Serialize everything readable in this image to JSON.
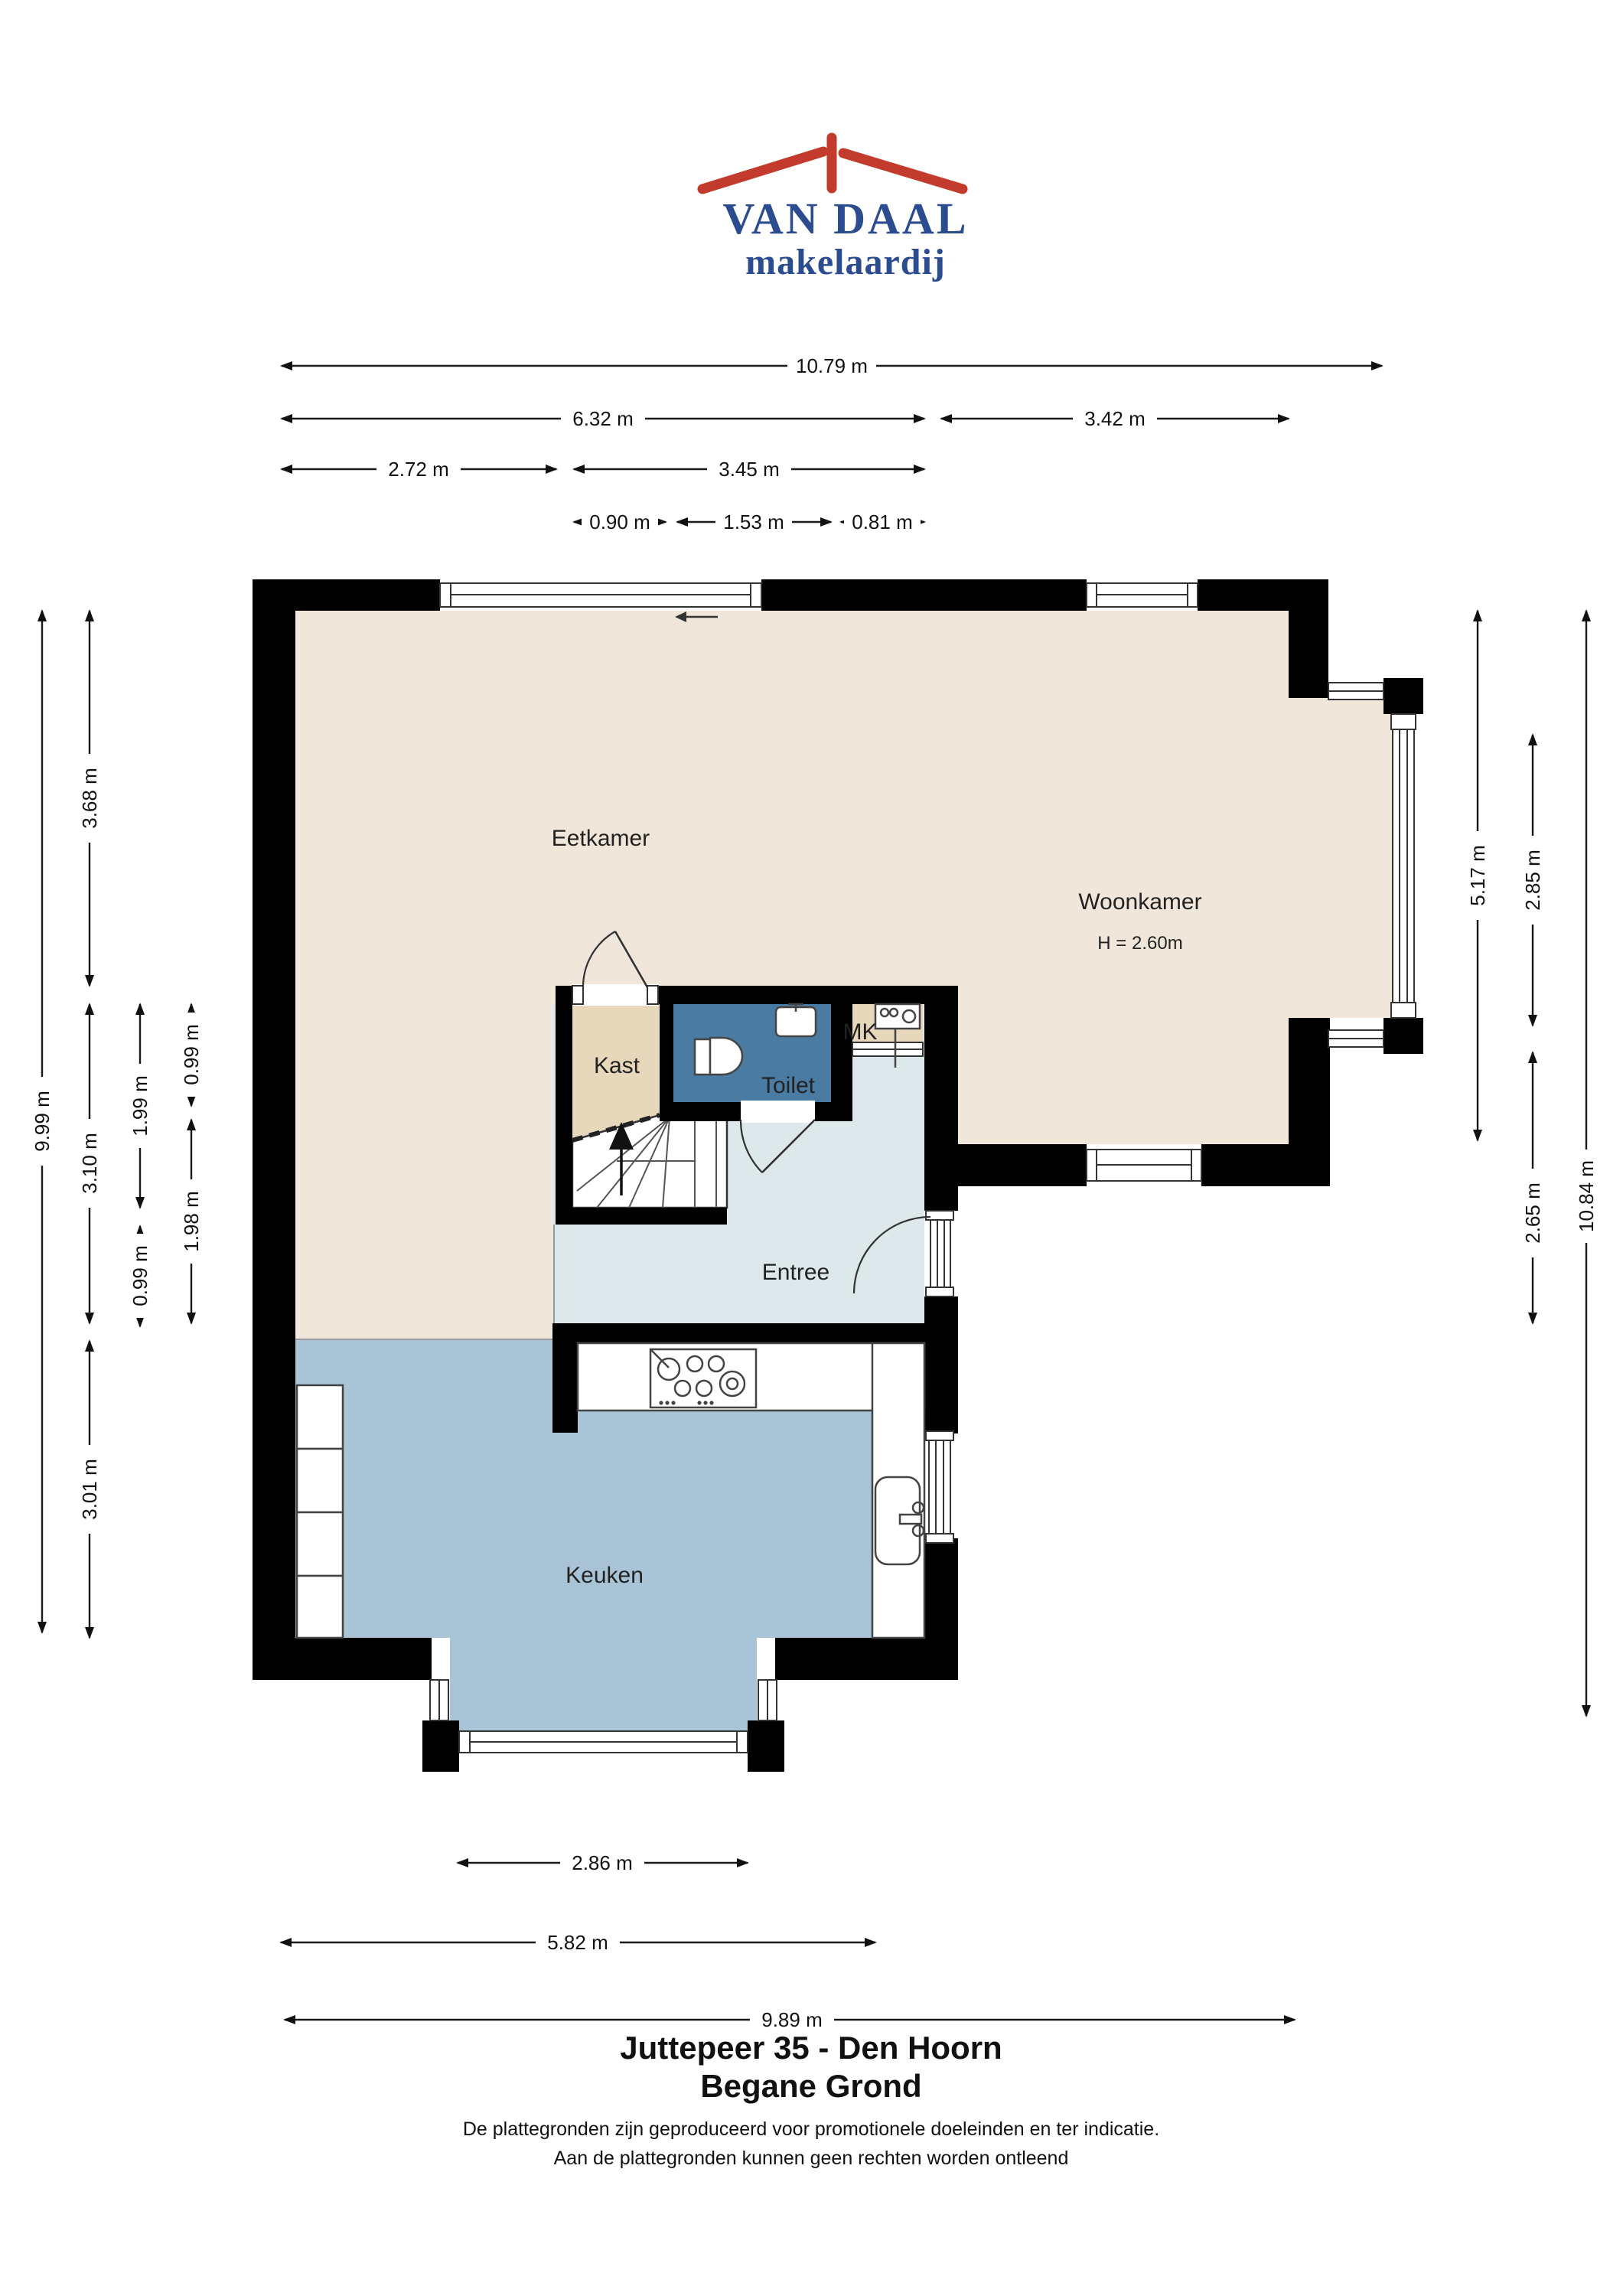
{
  "logo": {
    "brand": "VAN DAAL",
    "tagline": "makelaardij"
  },
  "rooms": {
    "eetkamer": "Eetkamer",
    "woonkamer": "Woonkamer",
    "woonkamer_height": "H = 2.60m",
    "kast": "Kast",
    "toilet": "Toilet",
    "mk": "MK",
    "entree": "Entree",
    "keuken": "Keuken"
  },
  "dimensions": {
    "top": {
      "d1079": "10.79 m",
      "d632": "6.32 m",
      "d342": "3.42 m",
      "d272": "2.72 m",
      "d345": "3.45 m",
      "d090": "0.90 m",
      "d153": "1.53 m",
      "d081": "0.81 m"
    },
    "left": {
      "d999": "9.99 m",
      "d368": "3.68 m",
      "d310": "3.10 m",
      "d301": "3.01 m",
      "d199": "1.99 m",
      "d099a": "0.99 m",
      "d099b": "0.99 m",
      "d198": "1.98 m"
    },
    "right": {
      "d517": "5.17 m",
      "d285": "2.85 m",
      "d265": "2.65 m",
      "d1084": "10.84 m"
    },
    "bottom": {
      "d286": "2.86 m",
      "d582": "5.82 m",
      "d989": "9.89 m"
    }
  },
  "footer": {
    "title_line1": "Juttepeer 35 - Den Hoorn",
    "title_line2": "Begane Grond",
    "disclaimer_line1": "De plattegronden zijn geproduceerd voor promotionele doeleinden en ter indicatie.",
    "disclaimer_line2": "Aan de plattegronden kunnen geen rechten worden ontleend"
  },
  "colors": {
    "wall": "#000000",
    "floor_living": "#f0e7da",
    "floor_closet": "#e7d7bb",
    "floor_toilet": "#4a7ba2",
    "floor_entree": "#dde8eb",
    "floor_kitchen": "#a8c4d6",
    "brand_red": "#c23b2c",
    "brand_blue": "#2b4c8e"
  }
}
